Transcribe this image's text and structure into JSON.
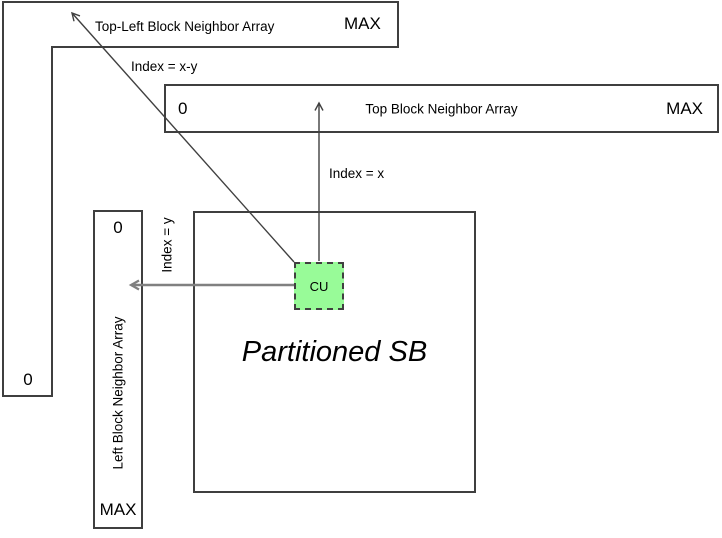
{
  "top_left_array": {
    "label": "Top-Left Block Neighbor Array",
    "max_label": "MAX",
    "zero_label": "0"
  },
  "top_array": {
    "zero_label": "0",
    "label": "Top Block Neighbor Array",
    "max_label": "MAX"
  },
  "left_array": {
    "zero_label": "0",
    "label": "Left Block Neighbor Array",
    "max_label": "MAX"
  },
  "sb": {
    "label": "Partitioned SB"
  },
  "cu": {
    "label": "CU"
  },
  "index_labels": {
    "top_left": "Index = x-y",
    "top": "Index = x",
    "left": "Index = y"
  },
  "colors": {
    "border": "#3f3f3f",
    "arrow_dark": "#404040",
    "arrow_gray": "#808080",
    "cu_fill": "#98FB98"
  }
}
